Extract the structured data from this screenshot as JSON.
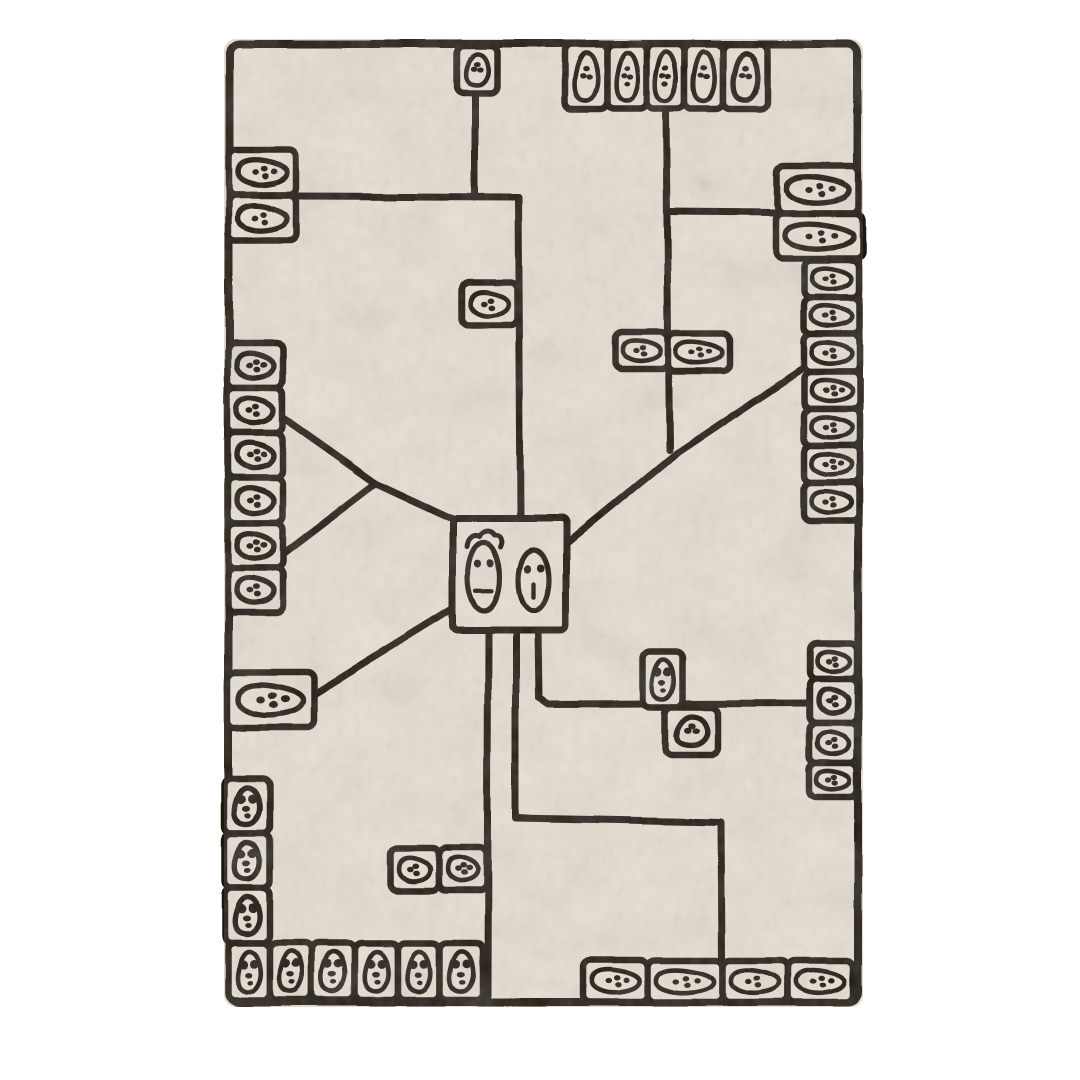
{
  "rug": {
    "colors": {
      "page": "#ffffff",
      "base": "#e7dfd2",
      "ink": "#1c1611",
      "texture_light": "#f0eadf",
      "texture_dark": "#d8cebc"
    },
    "frame": [
      229,
      44,
      629,
      958
    ],
    "lines": [
      [
        [
          475,
          90
        ],
        [
          475,
          197
        ]
      ],
      [
        [
          297,
          196
        ],
        [
          518,
          197
        ],
        [
          520,
          516
        ]
      ],
      [
        [
          666,
          110
        ],
        [
          669,
          450
        ]
      ],
      [
        [
          667,
          212
        ],
        [
          777,
          213
        ]
      ],
      [
        [
          806,
          366
        ],
        [
          678,
          452
        ],
        [
          566,
          544
        ]
      ],
      [
        [
          284,
          418
        ],
        [
          376,
          483
        ]
      ],
      [
        [
          284,
          553
        ],
        [
          376,
          483
        ]
      ],
      [
        [
          376,
          483
        ],
        [
          456,
          520
        ]
      ],
      [
        [
          313,
          695
        ],
        [
          454,
          608
        ]
      ],
      [
        [
          488,
          630
        ],
        [
          487,
          996
        ]
      ],
      [
        [
          516,
          630
        ],
        [
          516,
          818
        ],
        [
          721,
          822
        ],
        [
          722,
          958
        ]
      ],
      [
        [
          538,
          630
        ],
        [
          539,
          698
        ],
        [
          548,
          704
        ],
        [
          810,
          703
        ]
      ]
    ],
    "cells": [
      [
        228,
        150,
        69,
        45,
        "fh",
        4
      ],
      [
        228,
        195,
        69,
        45,
        "fh",
        3
      ],
      [
        457,
        46,
        40,
        47,
        "fv",
        3
      ],
      [
        565,
        44,
        42,
        65,
        "fv",
        3
      ],
      [
        607,
        44,
        40,
        65,
        "fv",
        4
      ],
      [
        647,
        44,
        38,
        65,
        "fv",
        4
      ],
      [
        685,
        44,
        38,
        65,
        "fv",
        3
      ],
      [
        723,
        44,
        44,
        65,
        "fv",
        3
      ],
      [
        777,
        166,
        82,
        47,
        "fh",
        4
      ],
      [
        775,
        213,
        88,
        45,
        "fh",
        4
      ],
      [
        804,
        260,
        55,
        38,
        "fh",
        3
      ],
      [
        804,
        298,
        55,
        36,
        "fh",
        3
      ],
      [
        804,
        334,
        55,
        38,
        "fh",
        3
      ],
      [
        804,
        372,
        55,
        37,
        "fh",
        4
      ],
      [
        804,
        409,
        55,
        37,
        "fh",
        3
      ],
      [
        804,
        446,
        55,
        37,
        "fh",
        4
      ],
      [
        804,
        483,
        55,
        38,
        "fh",
        3
      ],
      [
        462,
        282,
        55,
        43,
        "fh",
        3
      ],
      [
        616,
        332,
        52,
        37,
        "fh",
        3
      ],
      [
        668,
        333,
        62,
        38,
        "fh",
        4
      ],
      [
        643,
        652,
        40,
        55,
        "gh",
        0
      ],
      [
        665,
        707,
        53,
        48,
        "fv",
        3
      ],
      [
        810,
        643,
        47,
        35,
        "fh",
        3
      ],
      [
        810,
        678,
        47,
        45,
        "fh",
        3
      ],
      [
        810,
        723,
        47,
        40,
        "fh",
        3
      ],
      [
        810,
        763,
        47,
        34,
        "fh",
        3
      ],
      [
        228,
        343,
        55,
        45,
        "fh",
        4
      ],
      [
        228,
        388,
        55,
        45,
        "fh",
        3
      ],
      [
        228,
        433,
        55,
        45,
        "fh",
        4
      ],
      [
        228,
        478,
        55,
        45,
        "fh",
        3
      ],
      [
        228,
        523,
        55,
        45,
        "fh",
        4
      ],
      [
        228,
        568,
        55,
        45,
        "fh",
        3
      ],
      [
        228,
        672,
        85,
        55,
        "fh",
        4
      ],
      [
        225,
        779,
        45,
        54,
        "gh",
        0
      ],
      [
        225,
        833,
        45,
        55,
        "gh",
        0
      ],
      [
        225,
        888,
        45,
        55,
        "gh",
        0
      ],
      [
        228,
        943,
        42,
        57,
        "gh",
        0
      ],
      [
        270,
        943,
        42,
        57,
        "gh",
        0
      ],
      [
        312,
        943,
        43,
        57,
        "gh",
        0
      ],
      [
        355,
        943,
        43,
        57,
        "gh",
        0
      ],
      [
        398,
        943,
        42,
        57,
        "gh",
        0
      ],
      [
        440,
        943,
        42,
        57,
        "gh",
        0
      ],
      [
        391,
        848,
        48,
        43,
        "fh",
        3
      ],
      [
        439,
        848,
        47,
        43,
        "fh",
        4
      ],
      [
        583,
        960,
        65,
        42,
        "fh",
        4
      ],
      [
        648,
        960,
        75,
        42,
        "fh",
        4
      ],
      [
        723,
        960,
        65,
        42,
        "fh",
        3
      ],
      [
        788,
        960,
        65,
        42,
        "fh",
        4
      ]
    ],
    "box": {
      "x": 453,
      "y": 518,
      "w": 113,
      "h": 112
    },
    "faces": [
      {
        "cx": 484,
        "cy": 577,
        "rx": 16,
        "ry": 34,
        "hair": true,
        "mouth": "dash-h"
      },
      {
        "cx": 534,
        "cy": 580,
        "rx": 15,
        "ry": 30,
        "hair": false,
        "mouth": "dash-v"
      }
    ]
  }
}
